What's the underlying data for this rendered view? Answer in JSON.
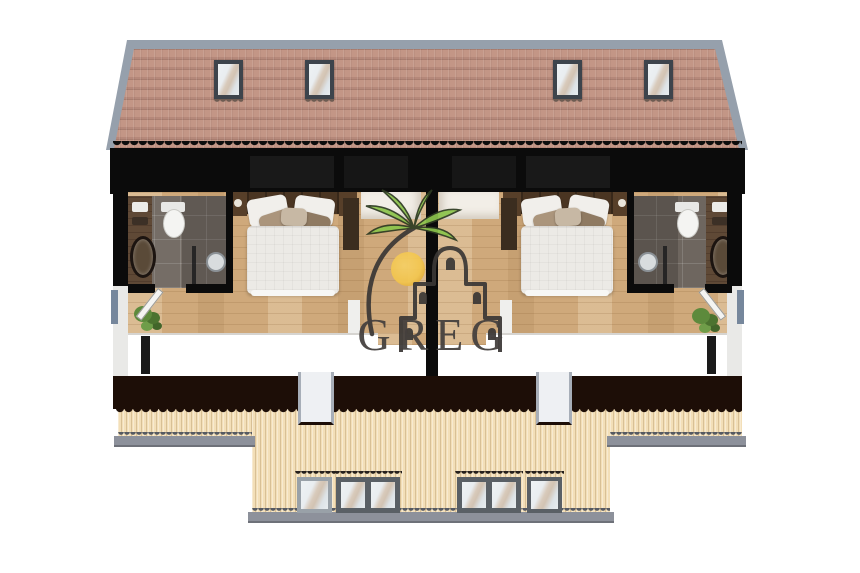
{
  "watermark": {
    "brand": "GREG",
    "text_color": "#45403e",
    "line_color": "#3b3836",
    "palm_green": "#8cc44c",
    "sun_yellow": "#f3c64e"
  },
  "scene": {
    "type": "architectural cutaway floor plan of attic level with roof above and front facade below",
    "roof": {
      "skylights": 4,
      "tile_color": "#bc9181",
      "ridge_color": "#99a2ae"
    },
    "floor_plan": {
      "units": 2,
      "mirrored": true,
      "rooms_per_unit": [
        "bathroom",
        "bedroom",
        "landing"
      ],
      "bathroom_fixtures": [
        "toilet",
        "shower",
        "vanity-with-round-mirror"
      ],
      "bathroom_tile_color": "#756d66",
      "vanity_wood_color": "#5c4734",
      "wood_floor_color": "#cfa97b",
      "bed": "double bed with white duvet and pillows",
      "plants": 2,
      "cut_wall_color": "#0b0b0b"
    },
    "facade": {
      "siding_color": "#f3dfb8",
      "plinth_color": "#8d919b",
      "front_band_color": "#1d0e07",
      "windows": 6,
      "window_groups": [
        3,
        3
      ],
      "white_roof_notches": 2,
      "window_frame_dark": "#5a6066",
      "window_frame_light": "#99a1a8"
    }
  }
}
